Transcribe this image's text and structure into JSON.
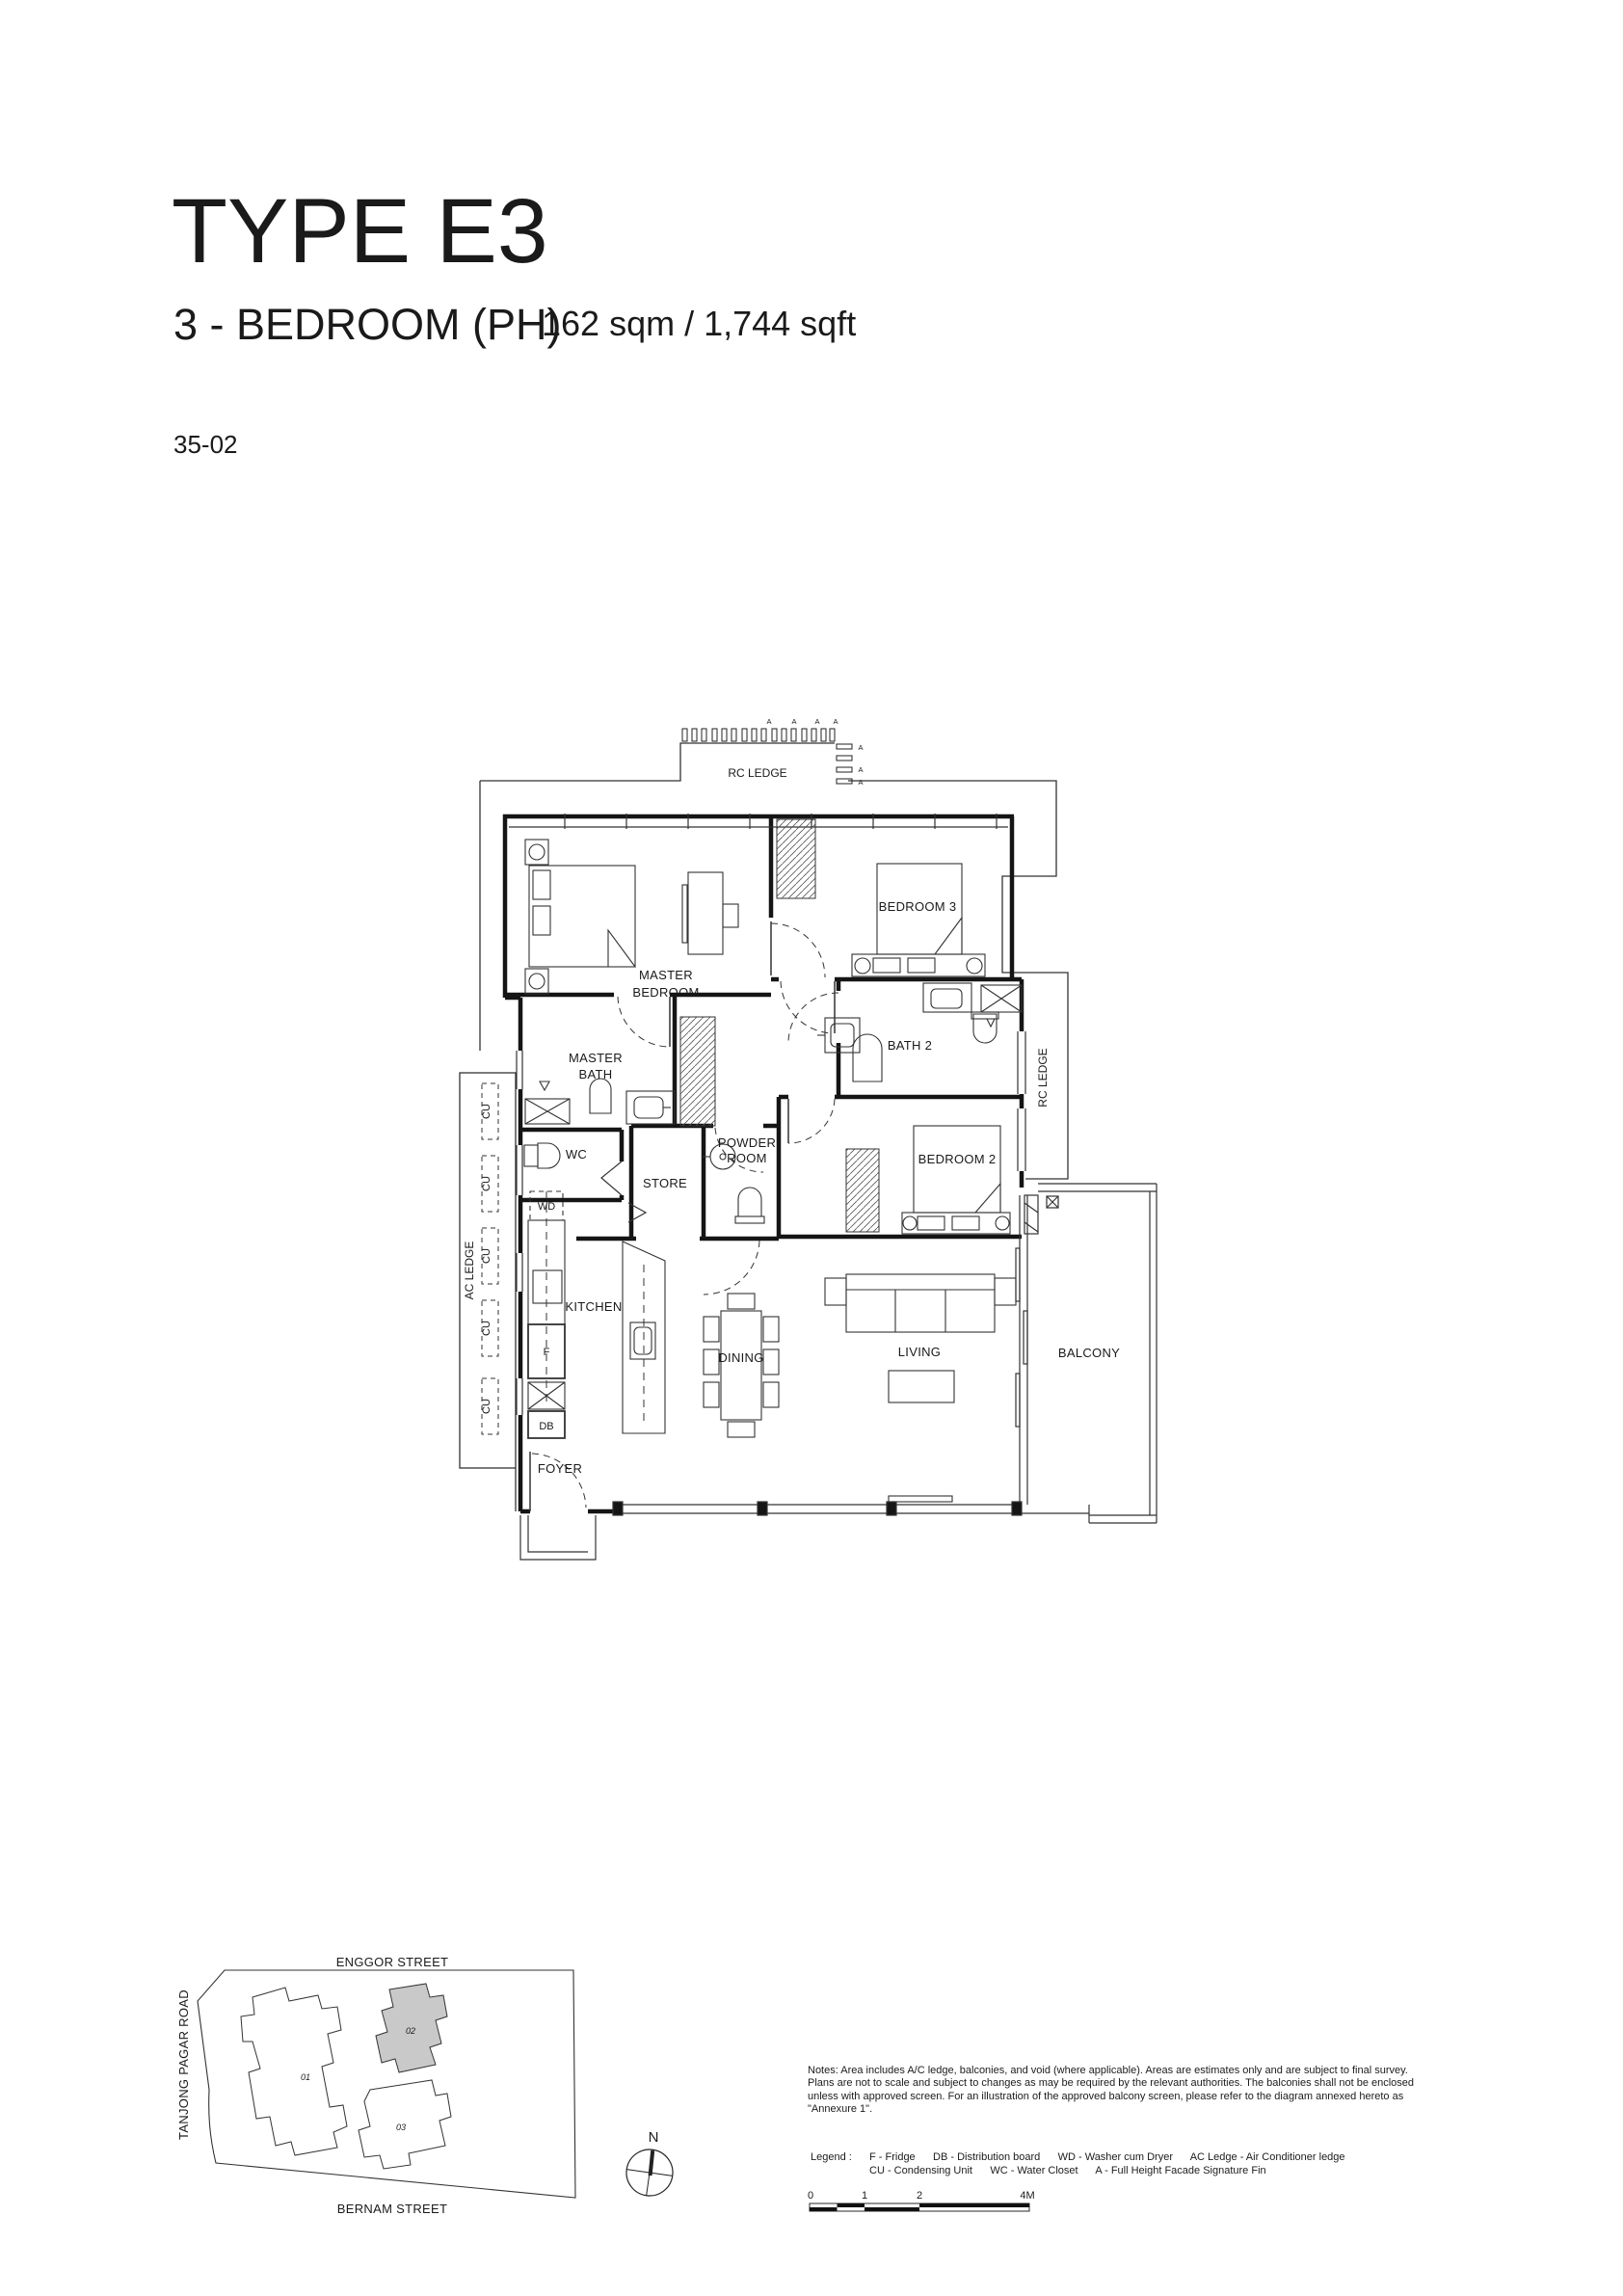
{
  "header": {
    "title": "TYPE E3",
    "subtitle": "3 - BEDROOM (PH)",
    "area": "162 sqm / 1,744 sqft",
    "unit_no": "35-02"
  },
  "plan": {
    "labels": {
      "rc_ledge": "RC LEDGE",
      "ac_ledge": "AC LEDGE",
      "fin": "A",
      "master_bedroom_1": "MASTER",
      "master_bedroom_2": "BEDROOM",
      "master_bath_1": "MASTER",
      "master_bath_2": "BATH",
      "bedroom_2": "BEDROOM 2",
      "bedroom_3": "BEDROOM 3",
      "bath_2": "BATH 2",
      "powder_1": "POWDER",
      "powder_2": "ROOM",
      "wc": "WC",
      "wd": "WD",
      "store": "STORE",
      "kitchen": "KITCHEN",
      "dining": "DINING",
      "living": "LIVING",
      "balcony": "BALCONY",
      "foyer": "FOYER",
      "fridge": "F",
      "db": "DB",
      "cu": "CU"
    }
  },
  "site_map": {
    "street_top": "ENGGOR STREET",
    "street_left": "TANJONG PAGAR ROAD",
    "street_bottom": "BERNAM STREET",
    "block_01": "01",
    "block_02": "02",
    "block_03": "03",
    "north": "N",
    "highlight_color": "#c9c9c9"
  },
  "notes": {
    "text": "Notes: Area includes A/C ledge, balconies, and void (where applicable). Areas are estimates only and are subject to final survey. Plans are not to scale and subject to changes as may be required by the relevant authorities. The balconies shall not be enclosed unless with approved screen. For an illustration of the approved balcony screen, please refer to the diagram annexed hereto as \"Annexure 1\"."
  },
  "legend": {
    "label": "Legend :",
    "line_1": "F - Fridge      DB - Distribution board      WD - Washer cum Dryer      AC Ledge - Air Conditioner ledge",
    "line_2": "CU - Condensing Unit      WC - Water Closet      A - Full Height Facade Signature Fin"
  },
  "scale_bar": {
    "ticks": [
      "0",
      "1",
      "2",
      "4M"
    ]
  }
}
